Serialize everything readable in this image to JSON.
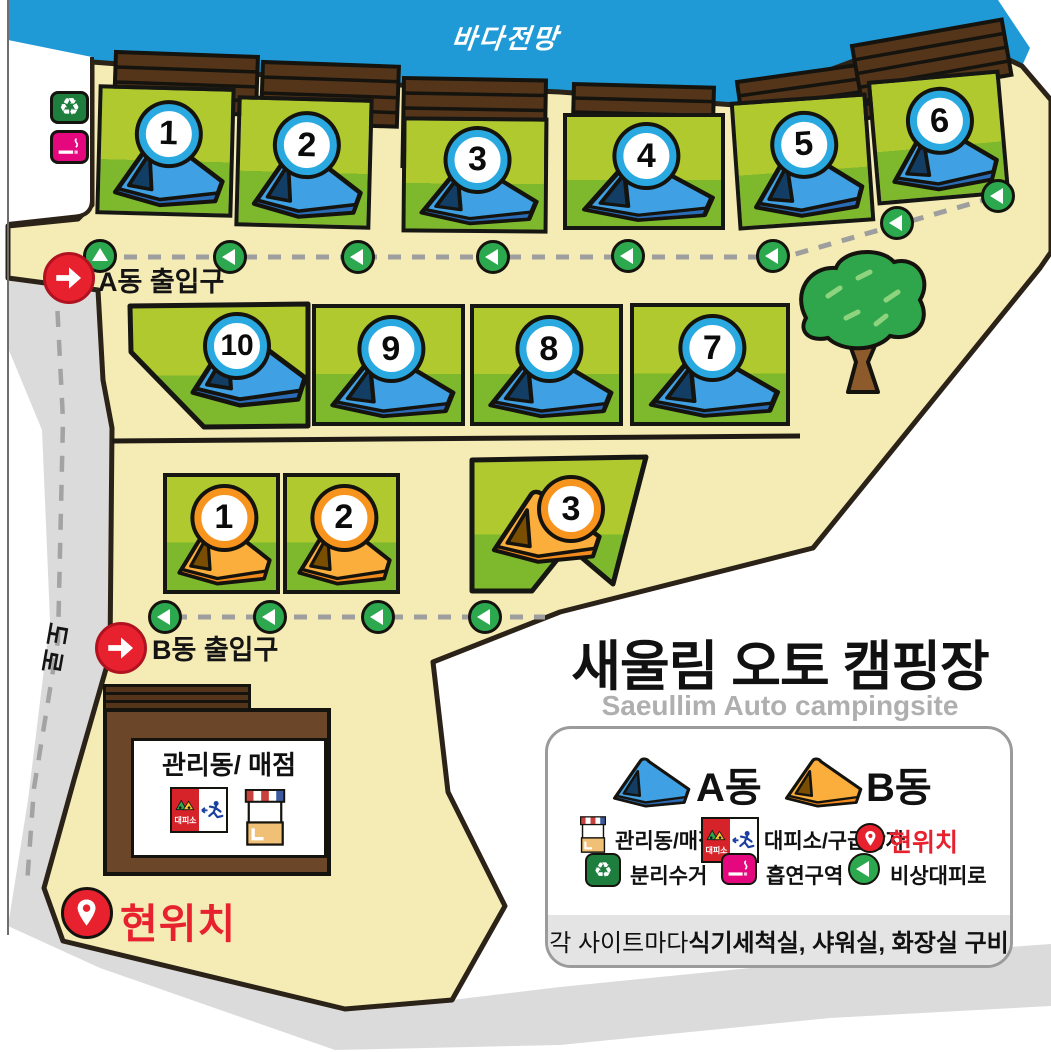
{
  "map": {
    "sea_view": "바다전망",
    "road": "도로",
    "entrance_a": "A동 출입구",
    "entrance_b": "B동 출입구",
    "current_location": "현위치",
    "building": "관리동/ 매점",
    "shelter_sign": "대피소",
    "sites_a": [
      "1",
      "2",
      "3",
      "4",
      "5",
      "6",
      "7",
      "8",
      "9",
      "10"
    ],
    "sites_b": [
      "1",
      "2",
      "3"
    ]
  },
  "title": {
    "main": "새울림 오토 캠핑장",
    "sub": "Saeullim Auto campingsite"
  },
  "legend": {
    "tent_a_label": "A동",
    "tent_b_label": "B동",
    "store_label": "관리동/매점",
    "shelter_label": "대피소/구급상자",
    "current_label": "현위치",
    "recycle_label": "분리수거",
    "smoking_label": "흡연구역",
    "route_label": "비상대피로",
    "note_normal": "각 사이트마다 ",
    "note_bold": "식기세척실, 샤워실, 화장실 구비",
    "shelter_sign": "대피소"
  },
  "colors": {
    "sky": "#1F9AD7",
    "ground": "#F5EBB4",
    "road": "#DBDBDB",
    "plot_light": "#AFC92F",
    "plot_dark": "#7DB82D",
    "tent_a": "#3FA0E4",
    "tent_b": "#FBAE3C",
    "accent_red": "#E8212E",
    "route_green": "#2CA84F",
    "fence_brown": "#54351A"
  }
}
